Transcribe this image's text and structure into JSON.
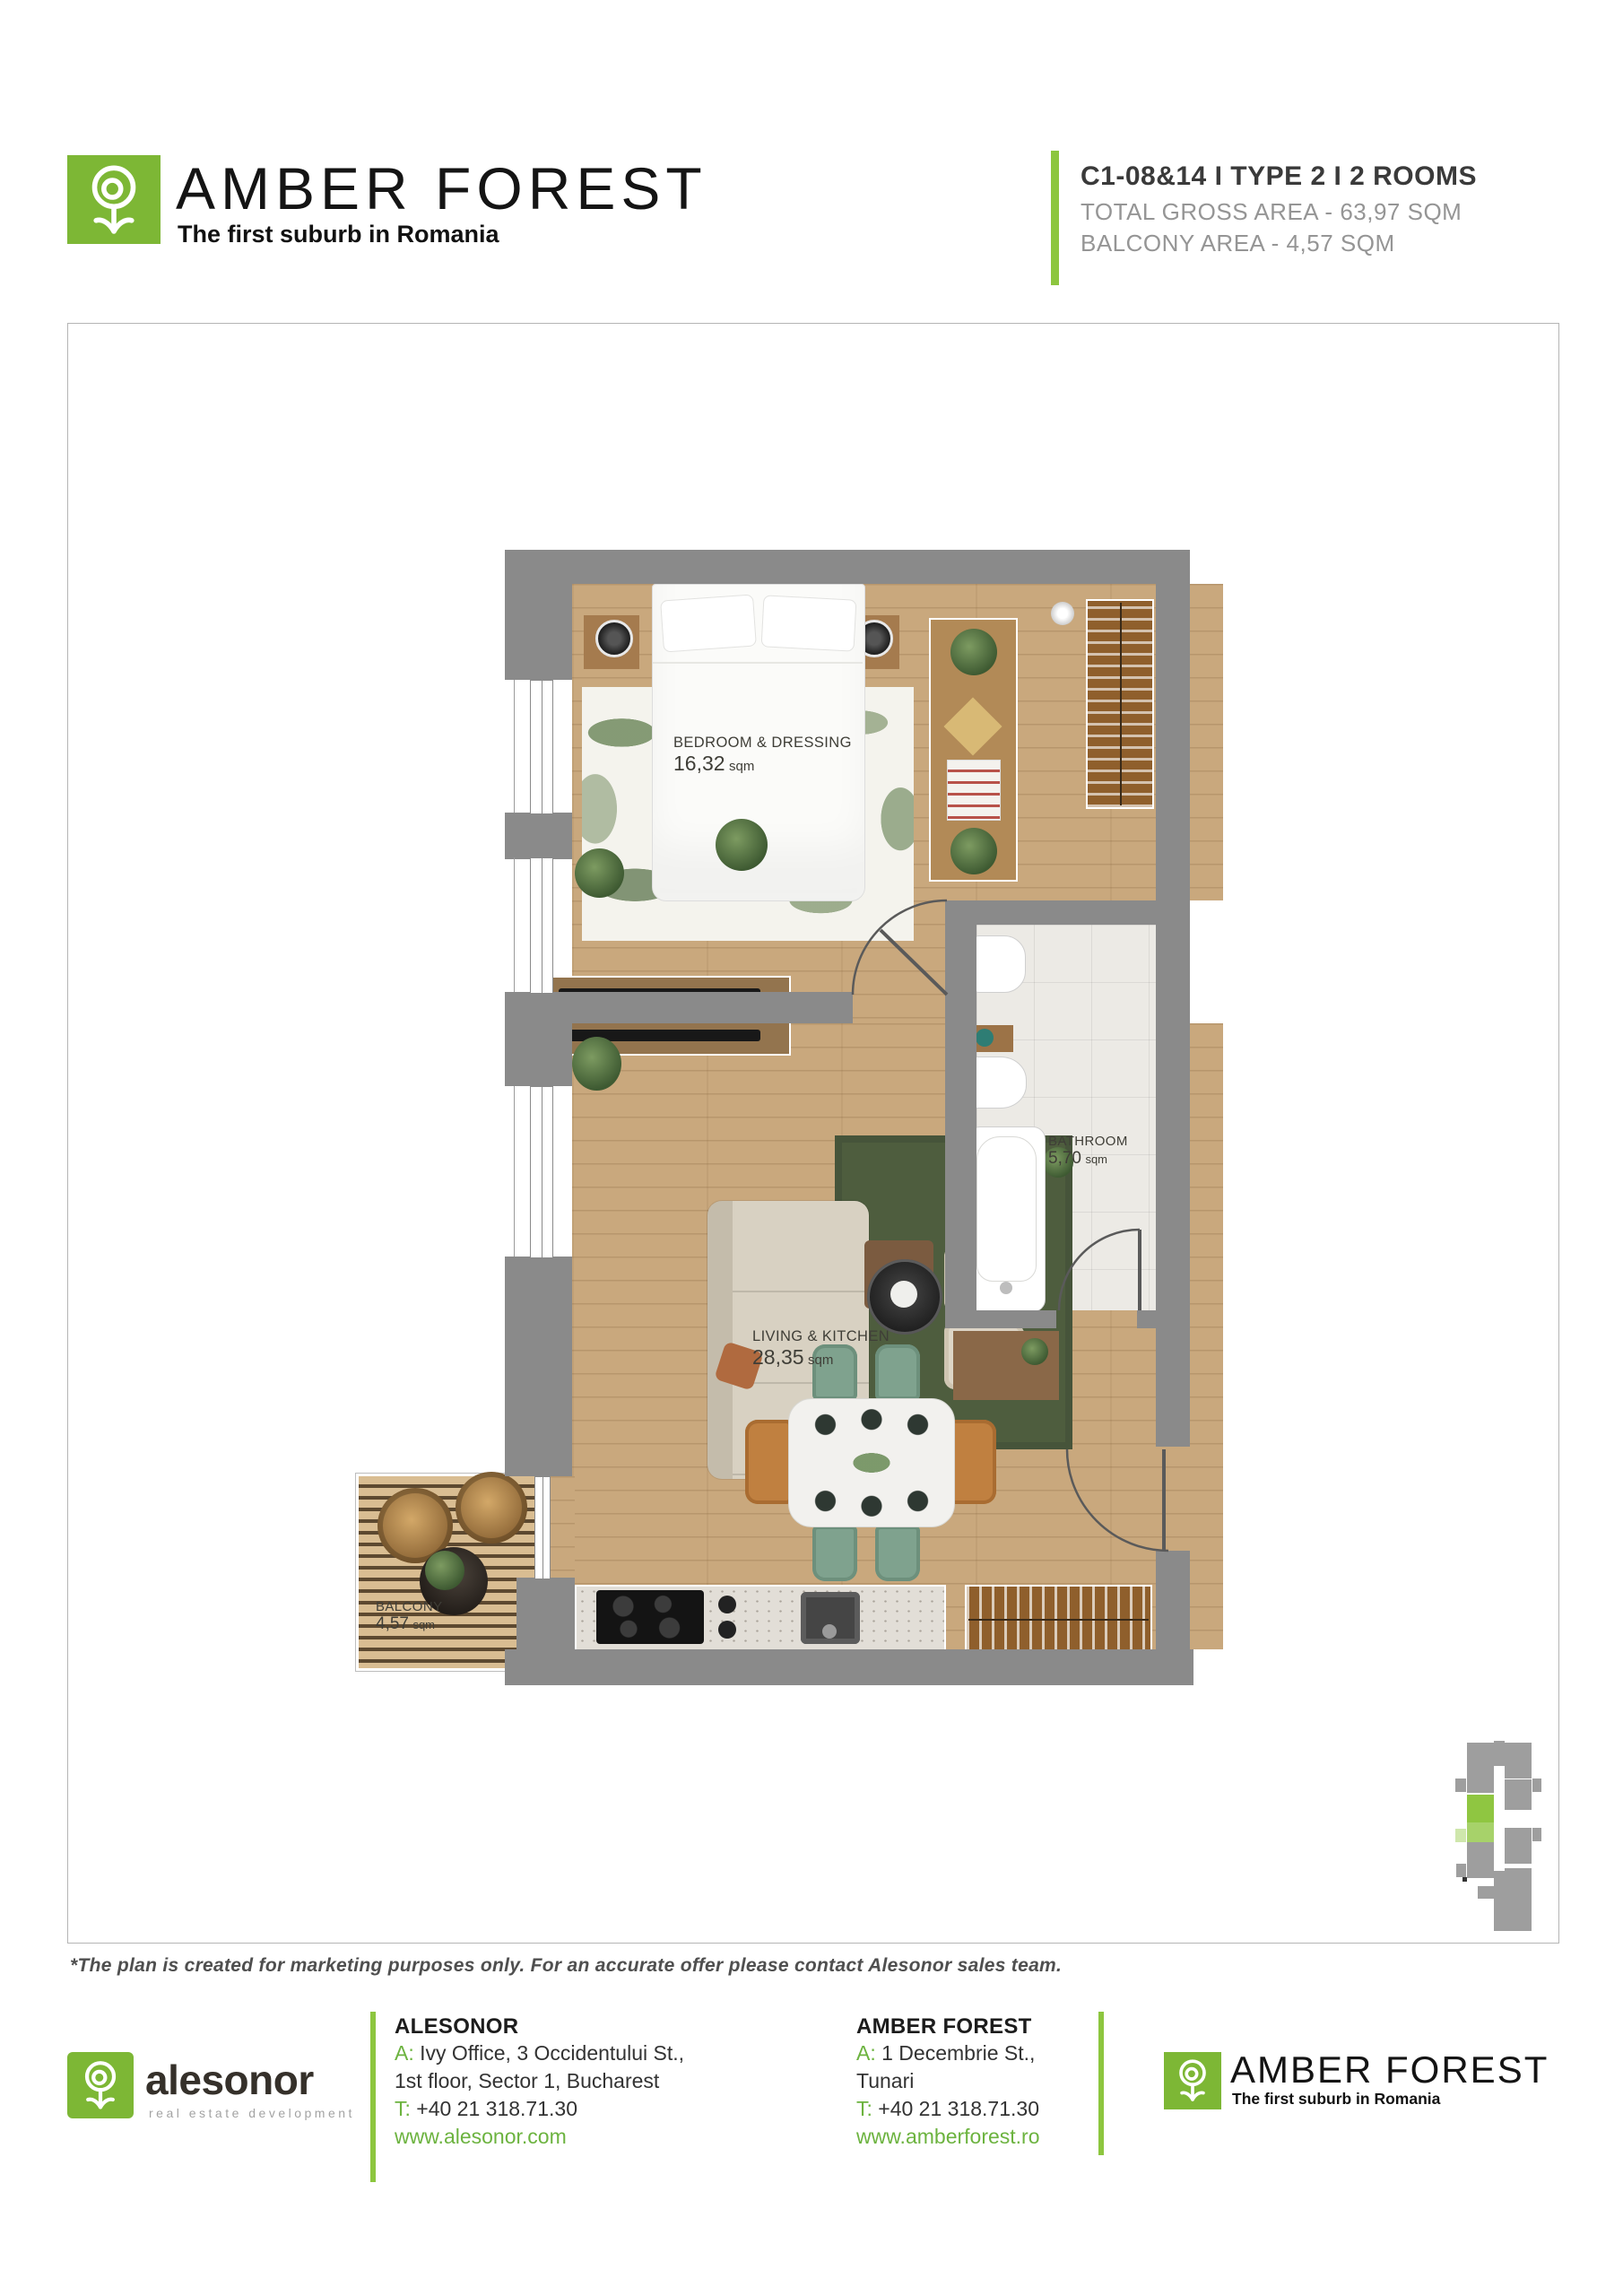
{
  "header": {
    "brand": "AMBER FOREST",
    "tagline": "The first suburb in Romania"
  },
  "unit_info": {
    "title": "C1-08&14 I TYPE 2 I 2 ROOMS",
    "gross_area": "TOTAL GROSS AREA - 63,97 SQM",
    "balcony_area": "BALCONY AREA - 4,57 SQM"
  },
  "plan": {
    "rooms": {
      "bedroom": {
        "name": "BEDROOM & DRESSING",
        "area": "16,32",
        "unit": "sqm"
      },
      "living": {
        "name": "LIVING & KITCHEN",
        "area": "28,35",
        "unit": "sqm"
      },
      "bathroom": {
        "name": "BATHROOM",
        "area": "5,70",
        "unit": "sqm"
      },
      "balcony": {
        "name": "BALCONY",
        "area": "4,57",
        "unit": "sqm"
      }
    }
  },
  "disclaimer": "*The plan is created for marketing purposes only. For an accurate offer please contact Alesonor sales team.",
  "footer": {
    "alesonor_logo": {
      "word": "alesonor",
      "sub": "real estate development"
    },
    "alesonor": {
      "heading": "ALESONOR",
      "addr_prefix": "A:",
      "addr_line1": "Ivy Office, 3 Occidentului St.,",
      "addr_line2": "1st floor, Sector 1, Bucharest",
      "tel_prefix": "T:",
      "tel": "+40 21 318.71.30",
      "web": "www.alesonor.com"
    },
    "amber": {
      "heading": "AMBER FOREST",
      "addr_prefix": "A:",
      "addr_line1": "1 Decembrie St.,",
      "addr_line2": "Tunari",
      "tel_prefix": "T:",
      "tel": "+40 21 318.71.30",
      "web": "www.amberforest.ro"
    },
    "amber_logo": {
      "brand": "AMBER FOREST",
      "tagline": "The first suburb in Romania"
    }
  },
  "colors": {
    "brand_green": "#7db735",
    "accent_green": "#8dc63f",
    "keyplan_unit_green": "#8fc641",
    "keyplan_balcony_green": "#cfe7ac",
    "wall_gray": "#8a8a8a"
  }
}
